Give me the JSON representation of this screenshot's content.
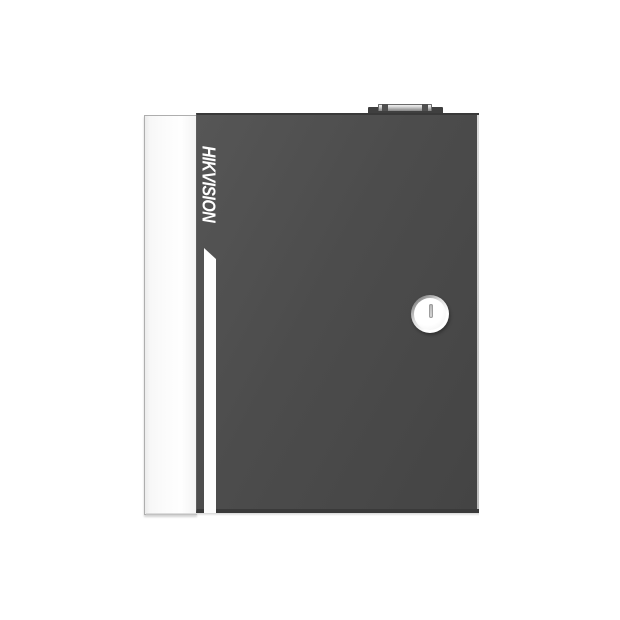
{
  "product": {
    "brand_label": "HIKVISION",
    "description": "Access controller metal enclosure, front product view on white background"
  },
  "icons": {
    "keyhole_icon": "vertical key slot in round lock cylinder",
    "hinge_knob_icon": "small raised hinge block on top edge"
  },
  "colors": {
    "background": "#ffffff",
    "door": "#4c4c4c",
    "door_light": "#565656",
    "door_dark": "#444444",
    "door_top_edge": "#393939",
    "edge_highlight": "#c9c9c9",
    "bottom_edge": "#3a3a3a",
    "drop_shadow": "#d6d6d6",
    "panel": "#fbfbfb",
    "panel_edge": "#aeaeae",
    "panel_shade": "#ececec",
    "stripe": "#fdfdfd",
    "logo_text": "#ffffff",
    "knob_base": "#3f3f3f",
    "knob_bar_light": "#e8e8e8",
    "knob_bar_dark": "#8d8d8d",
    "knob_nub": "#4f4f4f",
    "lock_ring_dark": "#6f6f6f",
    "lock_ring_light": "#ffffff",
    "lock_face": "#f5f5f5",
    "keyhole": "#c2c2c2",
    "keyhole_edge": "#9d9d9d"
  }
}
